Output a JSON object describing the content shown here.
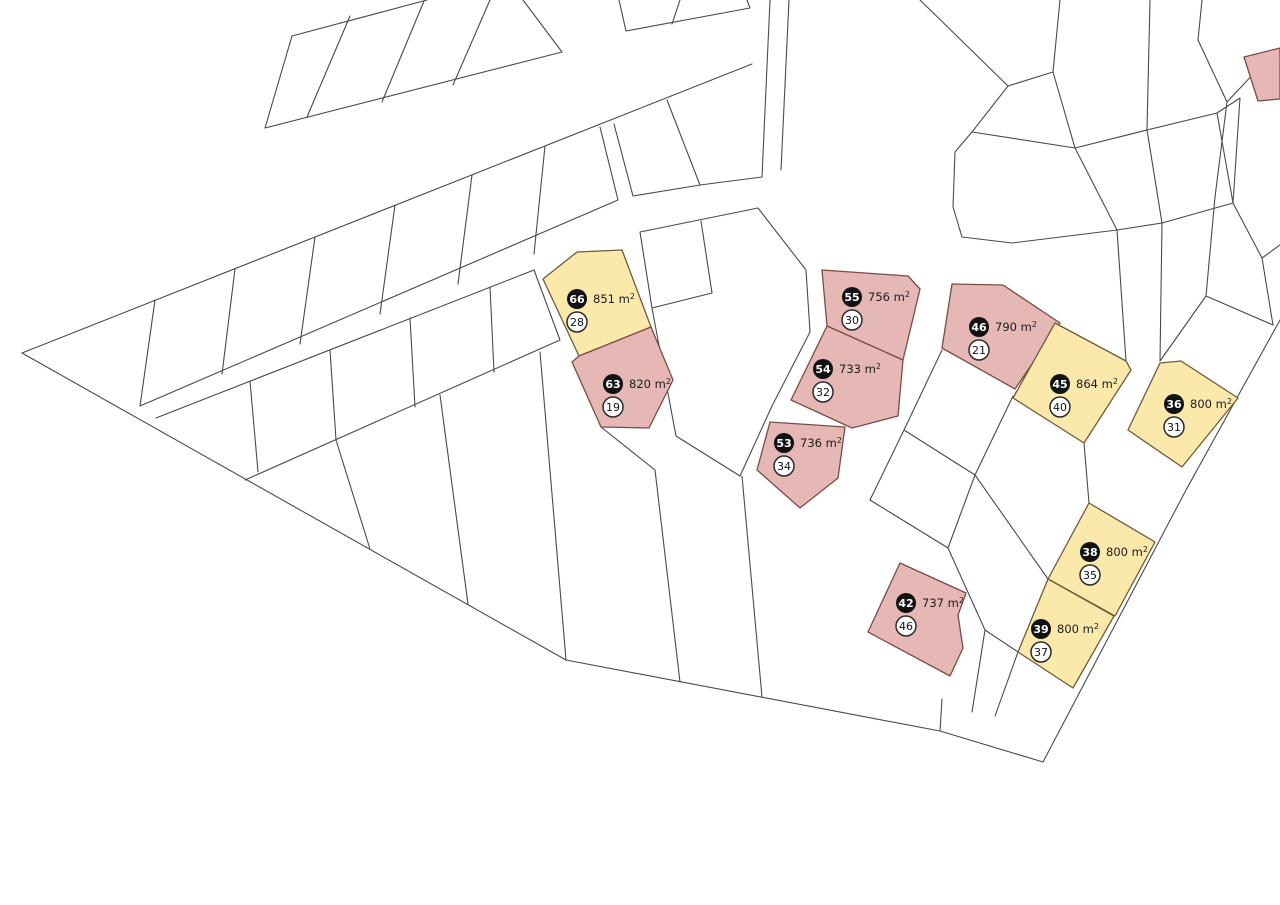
{
  "map": {
    "title": "land-plot-cadastral-map",
    "background": "#ffffff",
    "boundary_line_color": "#4a4a4a",
    "colors": {
      "yellow_parcel_fill": "#FAE9AB",
      "yellow_parcel_stroke": "#6e5b3a",
      "pink_parcel_fill": "#E5B8B6",
      "pink_parcel_stroke": "#7d4b43",
      "badge_black_fill": "#121212",
      "badge_black_text": "#ffffff",
      "badge_white_fill": "#ffffff",
      "badge_white_stroke": "#2b2b2b",
      "badge_white_text": "#111111",
      "area_text_color": "#1c1c1c"
    },
    "legend_note": "black badge = parcel number, white badge = lot number, text = area",
    "parcels": [
      {
        "id": "66",
        "badge": "66",
        "area": "851 m²",
        "lot": "28",
        "color": "yellow",
        "points": "543,279 577,252 622,250 651,327 579,356",
        "cx": 577,
        "cy": 299
      },
      {
        "id": "63",
        "badge": "63",
        "area": "820 m²",
        "lot": "19",
        "color": "pink",
        "points": "579,356 651,327 673,380 649,428 601,427 572,362",
        "cx": 613,
        "cy": 384
      },
      {
        "id": "55",
        "badge": "55",
        "area": "756 m²",
        "lot": "30",
        "color": "pink",
        "points": "822,270 908,276 920,289 903,360 827,326",
        "cx": 852,
        "cy": 297
      },
      {
        "id": "54",
        "badge": "54",
        "area": "733 m²",
        "lot": "32",
        "color": "pink",
        "points": "827,326 903,360 898,416 852,428 791,400",
        "cx": 823,
        "cy": 369
      },
      {
        "id": "53",
        "badge": "53",
        "area": "736 m²",
        "lot": "34",
        "color": "pink",
        "points": "770,422 845,427 838,478 800,508 757,470",
        "cx": 784,
        "cy": 443
      },
      {
        "id": "42",
        "badge": "42",
        "area": "737 m²",
        "lot": "46",
        "color": "pink",
        "points": "900,563 966,593 958,615 963,648 950,676 868,632",
        "cx": 906,
        "cy": 603
      },
      {
        "id": "46",
        "badge": "46",
        "area": "790 m²",
        "lot": "21",
        "color": "pink",
        "points": "952,284 1003,285 1060,323 1015,389 942,348",
        "cx": 979,
        "cy": 327
      },
      {
        "id": "45",
        "badge": "45",
        "area": "864 m²",
        "lot": "40",
        "color": "yellow",
        "points": "1055,323 1126,361 1131,370 1084,443 1013,398",
        "cx": 1060,
        "cy": 384
      },
      {
        "id": "36",
        "badge": "36",
        "area": "800 m²",
        "lot": "31",
        "color": "yellow",
        "points": "1160,363 1181,361 1238,398 1182,467 1128,430",
        "cx": 1174,
        "cy": 404
      },
      {
        "id": "38",
        "badge": "38",
        "area": "800 m²",
        "lot": "35",
        "color": "yellow",
        "points": "1089,503 1155,542 1115,616 1048,579",
        "cx": 1090,
        "cy": 552
      },
      {
        "id": "39",
        "badge": "39",
        "area": "800 m²",
        "lot": "37",
        "color": "yellow",
        "points": "1048,579 1114,616 1073,688 1018,652",
        "cx": 1041,
        "cy": 629
      },
      {
        "id": "edge-sliver",
        "badge": "",
        "area": "",
        "lot": "",
        "color": "pink",
        "points": "1244,57 1280,48 1280,99 1258,101",
        "cx": 0,
        "cy": 0
      }
    ]
  }
}
